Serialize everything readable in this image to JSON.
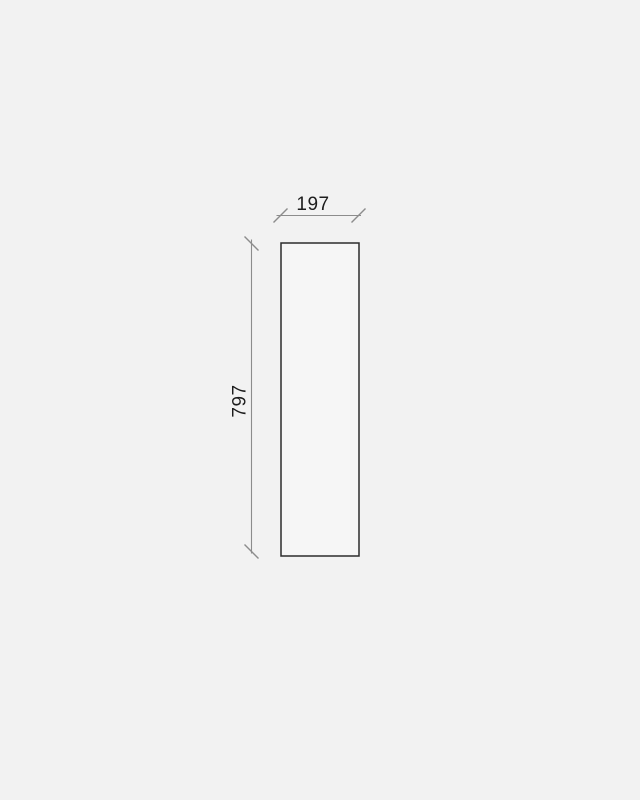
{
  "drawing": {
    "panel": {
      "width_label": "197",
      "height_label": "797"
    },
    "colors": {
      "background": "#f2f2f2",
      "panel_fill": "#f6f6f6",
      "panel_stroke": "#2c2c2c",
      "dimension": "#8c8c8c",
      "text": "#1d1d1d"
    }
  }
}
